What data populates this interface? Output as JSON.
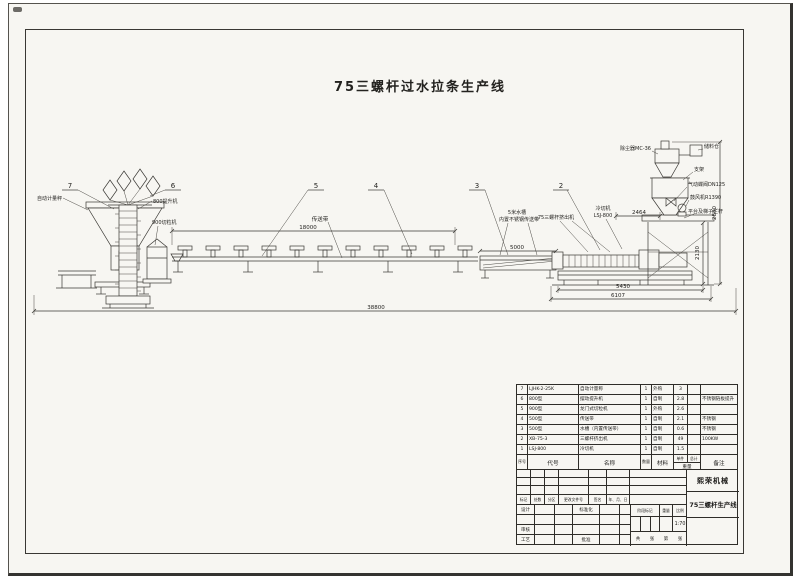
{
  "sheet": {
    "main_title": "75三螺杆过水拉条生产线"
  },
  "schematic": {
    "balloons": {
      "b7": "7",
      "b6": "6",
      "b5": "5",
      "b4": "4",
      "b3": "3",
      "b2": "2"
    },
    "labels": {
      "weigher": "自动计量秤",
      "elevator": "800提升机",
      "pelletizer": "900切粒机",
      "conveyor": "传送带",
      "tank_line1": "5米水槽",
      "tank_line2": "内置不锈钢传送带",
      "extruder": "75三螺杆挤出机",
      "cutter_line1": "冷切机",
      "cutter_line2": "LSJ-800",
      "dust_collector": "除尘器MC-36",
      "storage_bin": "储料仓",
      "bracket": "支架",
      "valve": "气动蝶阀DN125",
      "blower": "鼓风机R1390",
      "platform": "平台及梯子栏杆"
    },
    "dims": {
      "conveyor": "18000",
      "tank": "5000",
      "head": "2464",
      "extruder_base": "5430",
      "extruder_total": "6107",
      "total": "38800",
      "tower_h": "2880",
      "right_h": "2130"
    }
  },
  "bom": {
    "headers": {
      "seq": "序号",
      "code": "代号",
      "name": "名称",
      "qty": "数量",
      "material": "材料",
      "unit": "单件",
      "total": "总计",
      "weight": "重量",
      "remark": "备注"
    },
    "rows": [
      {
        "seq": "7",
        "code": "LJHK-2-25K",
        "name": "自动计量称",
        "qty": "1",
        "material": "外购",
        "unit_w": "3",
        "total_w": "",
        "remark": ""
      },
      {
        "seq": "6",
        "code": "800型",
        "name": "摆动提升机",
        "qty": "1",
        "material": "自制",
        "unit_w": "2.8",
        "total_w": "",
        "remark": "不锈钢链板提升"
      },
      {
        "seq": "5",
        "code": "900型",
        "name": "龙门式切粒机",
        "qty": "1",
        "material": "外购",
        "unit_w": "2.6",
        "total_w": "",
        "remark": ""
      },
      {
        "seq": "4",
        "code": "500型",
        "name": "传送带",
        "qty": "1",
        "material": "自制",
        "unit_w": "2.1",
        "total_w": "",
        "remark": "不锈钢"
      },
      {
        "seq": "3",
        "code": "500型",
        "name": "水槽（内置传送带）",
        "qty": "1",
        "material": "自制",
        "unit_w": "0.6",
        "total_w": "",
        "remark": "不锈钢"
      },
      {
        "seq": "2",
        "code": "XB-75-3",
        "name": "三螺杆挤出机",
        "qty": "1",
        "material": "自制",
        "unit_w": "49",
        "total_w": "",
        "remark": "100KW"
      },
      {
        "seq": "1",
        "code": "LSJ-800",
        "name": "冷切机",
        "qty": "1",
        "material": "自制",
        "unit_w": "1.5",
        "total_w": "",
        "remark": ""
      }
    ]
  },
  "title_block": {
    "company": "熙荣机械",
    "drawing_name": "75三螺杆生产线",
    "rev_cols": {
      "mark": "标记",
      "count": "处数",
      "zone": "分区",
      "doc_no": "更改文件号",
      "sign": "签名",
      "date": "年、月、日"
    },
    "roles": {
      "design": "设计",
      "standard": "标准化",
      "audit": "审核",
      "process": "工艺",
      "approve": "批准"
    },
    "stage_label": "阶段标记",
    "weight_label": "重量",
    "scale_label": "比例",
    "scale_value": "1:70",
    "sheets": {
      "c1": "共",
      "c2": "张",
      "c3": "第",
      "c4": "张"
    }
  }
}
